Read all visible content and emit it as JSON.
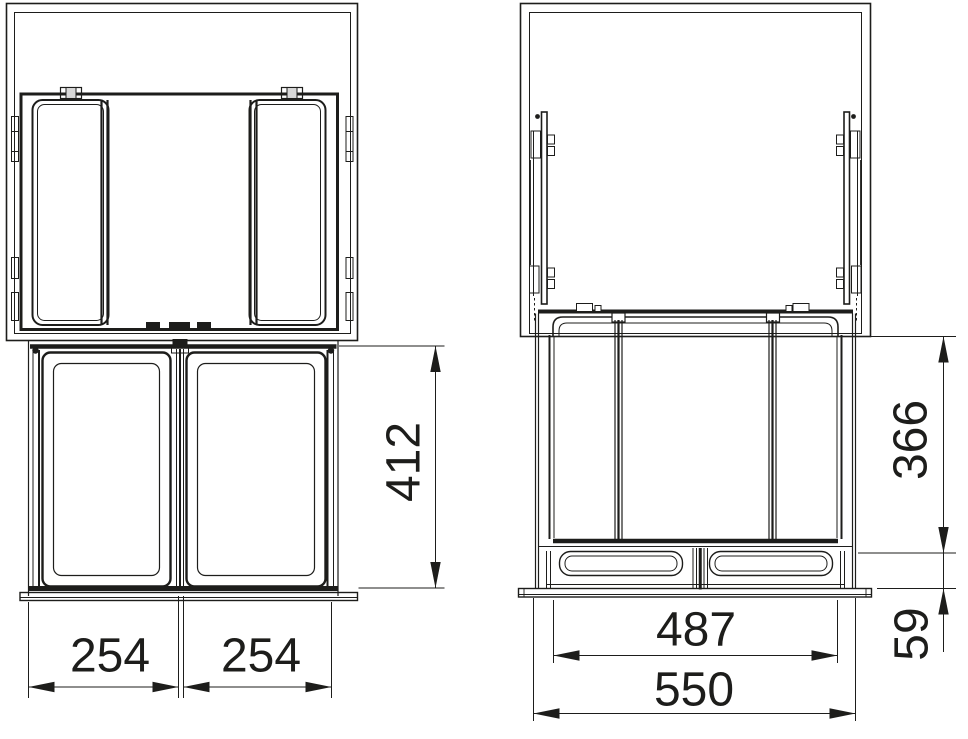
{
  "document": {
    "type": "technical-drawing",
    "subject": "pull-out-double-waste-bin-cabinet",
    "units": "mm",
    "background": "#ffffff",
    "line_color": "#1d1d1b"
  },
  "views": {
    "front_view": {
      "name": "plan-and-front-view",
      "dims": {
        "left_bin_width": "254",
        "right_bin_width": "254",
        "front_height": "412"
      }
    },
    "side_view": {
      "name": "side-section-view",
      "dims": {
        "bin_section_height": "366",
        "base_section_height": "59",
        "runner_width": "487",
        "overall_width": "550"
      }
    }
  }
}
